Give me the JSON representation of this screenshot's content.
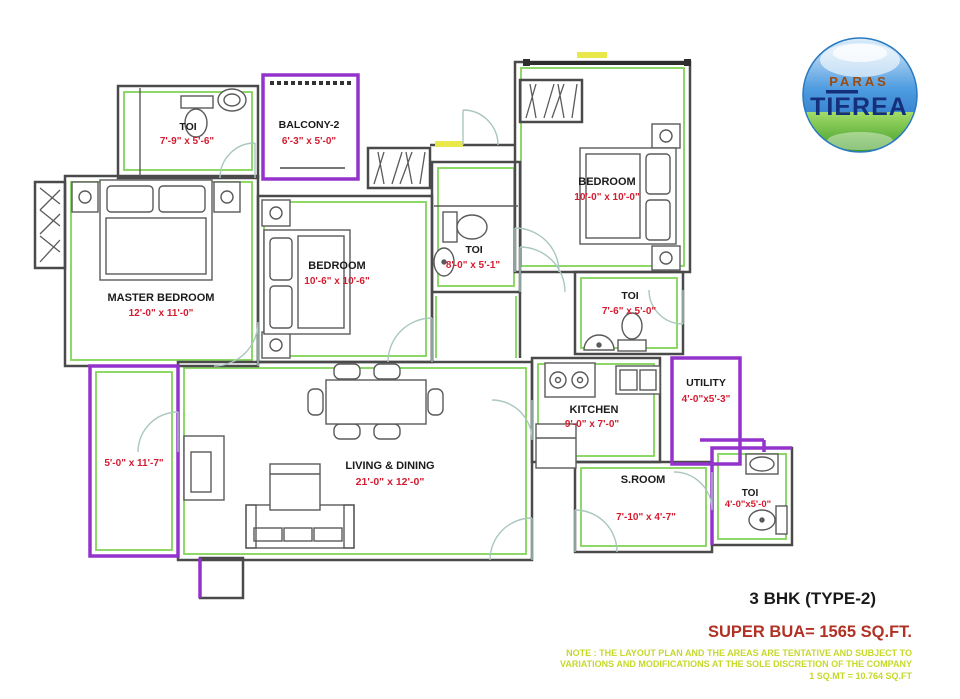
{
  "logo": {
    "brand_top": "PARAS",
    "brand_main": "TIEREA"
  },
  "rooms": {
    "toi_master": {
      "name": "TOI",
      "dims": "7'-9\" x 5'-6\""
    },
    "balcony2": {
      "name": "BALCONY-2",
      "dims": "6'-3\" x 5'-0\""
    },
    "bedroom_top": {
      "name": "BEDROOM",
      "dims": "10'-0\" x 10'-0\""
    },
    "toi_center": {
      "name": "TOI",
      "dims": "8'-0\" x 5'-1\""
    },
    "bedroom_mid": {
      "name": "BEDROOM",
      "dims": "10'-6\" x 10'-6\""
    },
    "master_bedroom": {
      "name": "MASTER BEDROOM",
      "dims": "12'-0\" x 11'-0\""
    },
    "toi_right": {
      "name": "TOI",
      "dims": "7'-6\" x 5'-0\""
    },
    "kitchen": {
      "name": "KITCHEN",
      "dims": "9'-0\" x 7'-0\""
    },
    "utility": {
      "name": "UTILITY",
      "dims": "4'-0\"x5'-3\""
    },
    "living_dining": {
      "name": "LIVING & DINING",
      "dims": "21'-0\" x 12'-0\""
    },
    "balcony_left": {
      "dims": "5'-0\" x 11'-7\""
    },
    "s_room": {
      "name": "S.ROOM",
      "dims": "7'-10\" x 4'-7\""
    },
    "toi_bottom": {
      "name": "TOI",
      "dims": "4'-0\"x5'-0\""
    }
  },
  "footer": {
    "unit_type": "3 BHK (TYPE-2)",
    "super_bua": "SUPER BUA= 1565 SQ.FT.",
    "note_line1": "NOTE : THE LAYOUT PLAN AND THE AREAS ARE TENTATIVE AND SUBJECT TO",
    "note_line2": "VARIATIONS AND MODIFICATIONS AT THE SOLE DISCRETION OF THE COMPANY",
    "note_line3": "1 SQ.MT = 10.764 SQ.FT"
  },
  "colors": {
    "wall": "#4a4a4a",
    "accent_green": "#82d45a",
    "balcony_purple": "#9333cc",
    "dim_red": "#d41c30",
    "note_yellow": "#c6d92b",
    "super_bua_red": "#b03224",
    "logo_navy": "#14307a",
    "logo_orange": "#9c4a0e"
  }
}
